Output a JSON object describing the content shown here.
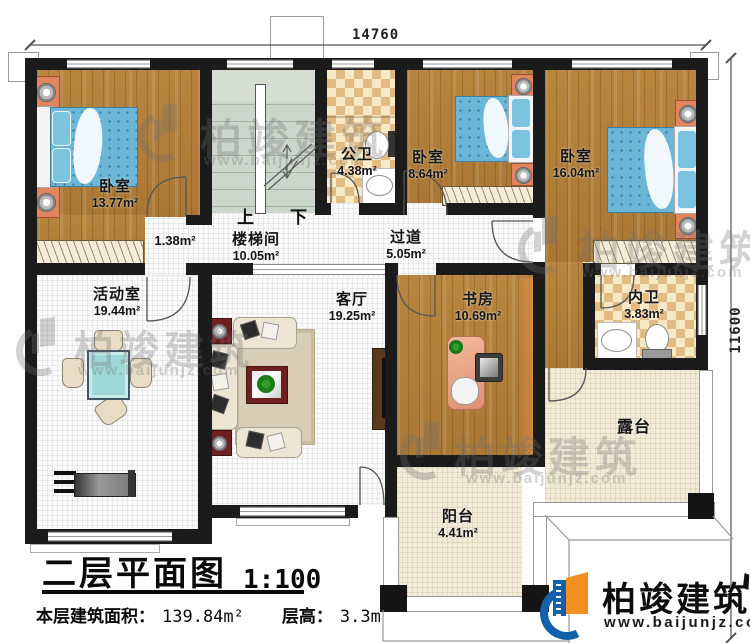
{
  "dimensions": {
    "top": "14760",
    "right": "11600"
  },
  "rooms": [
    {
      "name": "卧室",
      "area": "13.77m²"
    },
    {
      "name": "楼梯间",
      "area": "10.05m²"
    },
    {
      "name": "公卫",
      "area": "4.38m²"
    },
    {
      "name": "卧室",
      "area": "8.64m²"
    },
    {
      "name": "卧室",
      "area": "16.04m²"
    },
    {
      "name": "过道",
      "area": "5.05m²"
    },
    {
      "name": "活动室",
      "area": "19.44m²"
    },
    {
      "name": "客厅",
      "area": "19.25m²"
    },
    {
      "name": "书房",
      "area": "10.69m²"
    },
    {
      "name": "内卫",
      "area": "3.83m²"
    },
    {
      "name": "露台",
      "area": ""
    },
    {
      "name": "阳台",
      "area": "4.41m²"
    },
    {
      "name": "",
      "area": "1.38m²"
    }
  ],
  "stairs": {
    "up": "上",
    "down": "下"
  },
  "title": {
    "text": "二层平面图",
    "scale": "1:100"
  },
  "stats": {
    "area_label": "本层建筑面积：",
    "area_value": "139.84m²",
    "height_label": "层高：",
    "height_value": "3.3m"
  },
  "brand": {
    "name": "柏竣建筑",
    "url": "www.baijunjz.com"
  },
  "colors": {
    "wall": "#1b1b1b",
    "wood": "#b07c3a",
    "tile_light": "#f7e9c6",
    "tile_dark": "#e2bb82",
    "stair": "#ccd6cc",
    "bed": "#6cb7d8",
    "terrace": "#f0ecd8",
    "logo_blue": "#1360ab",
    "logo_orange": "#f29120"
  }
}
